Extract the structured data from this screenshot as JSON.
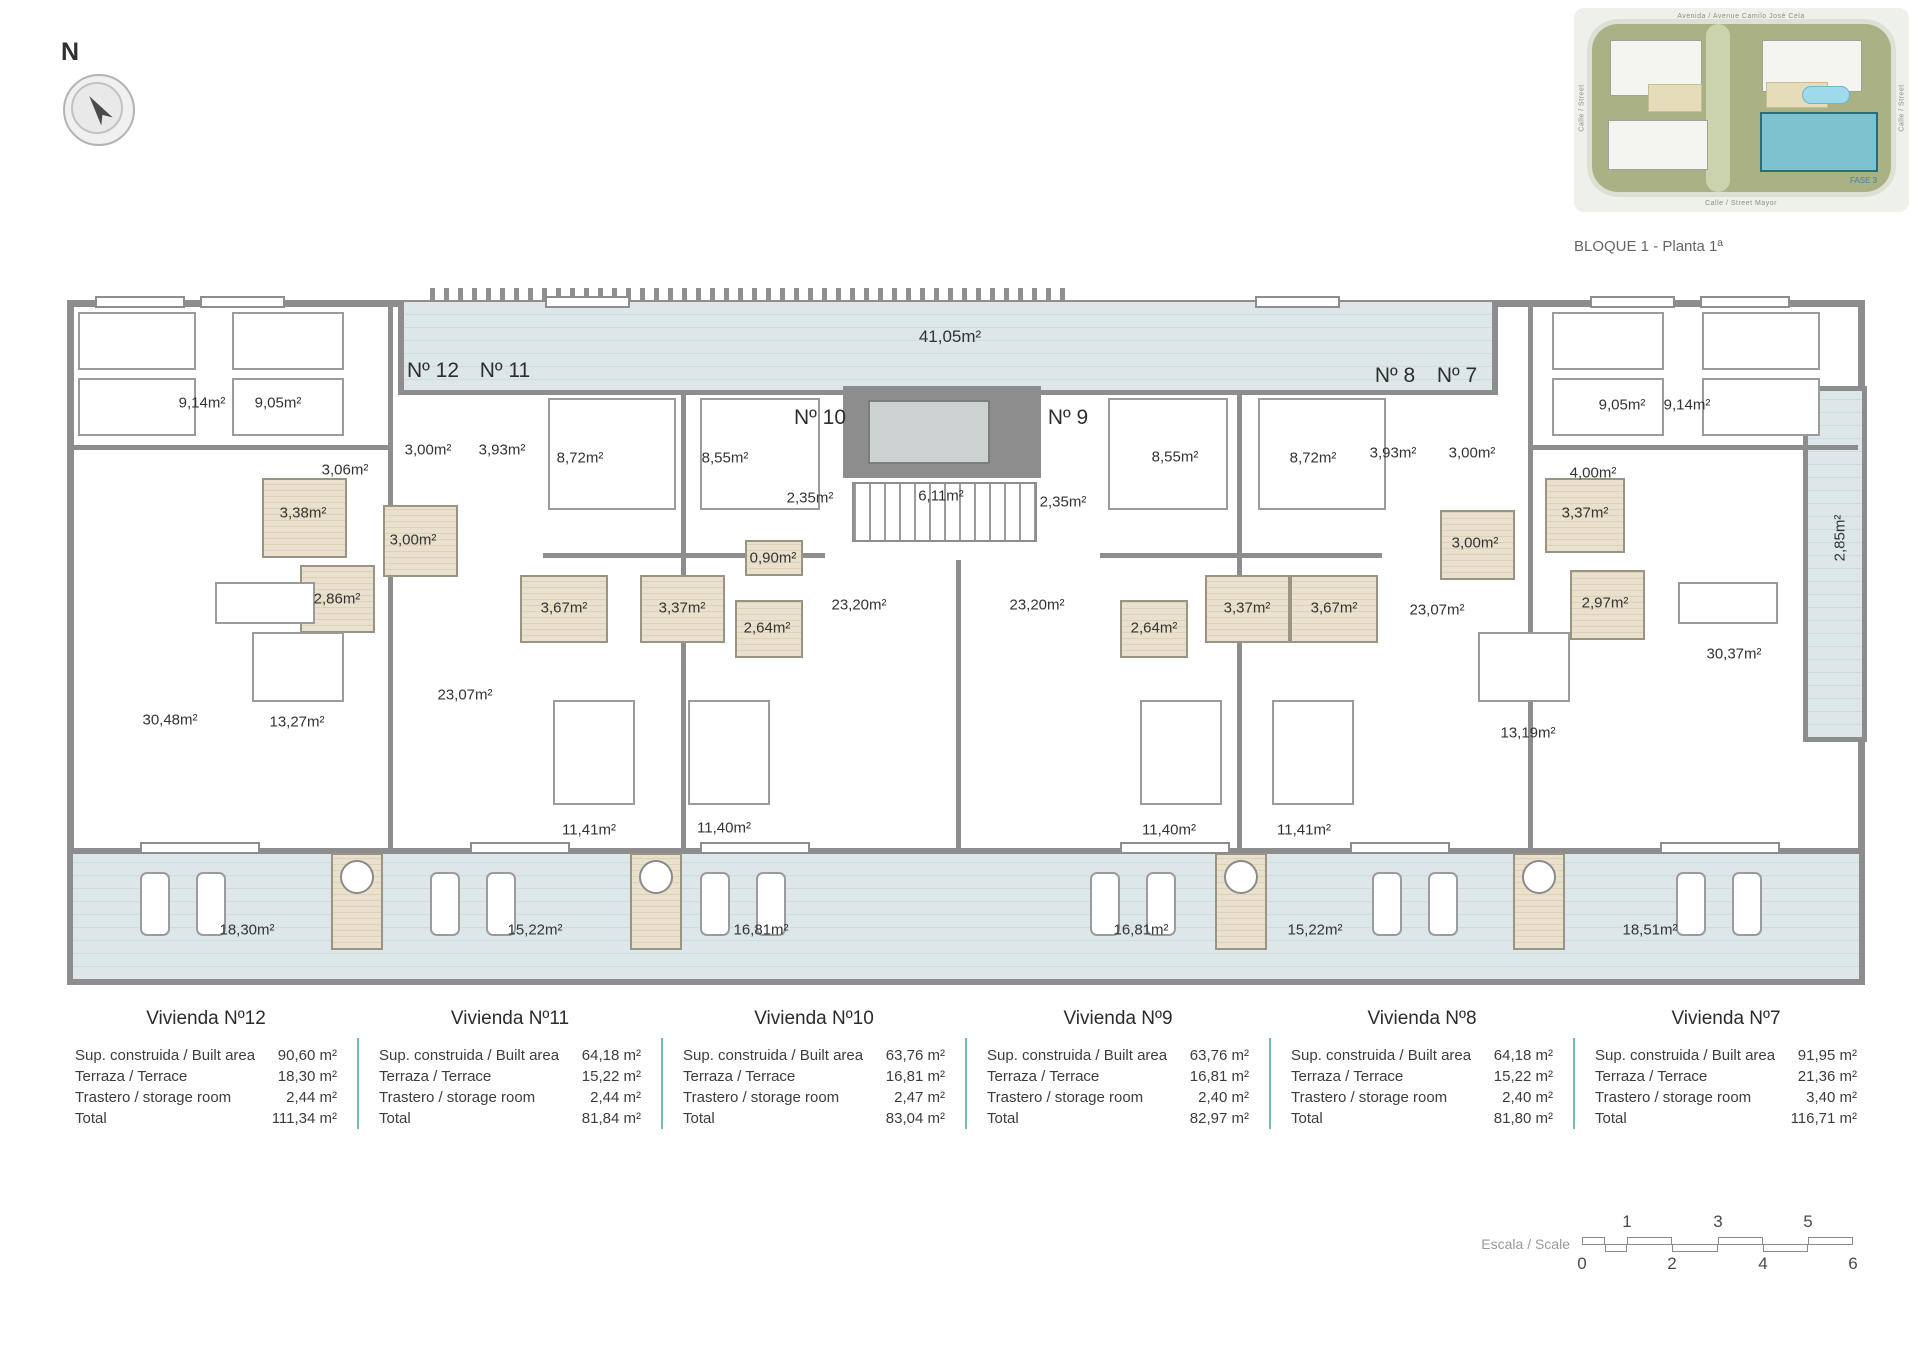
{
  "header": {
    "caption": "BLOQUE 1 - Planta 1ª",
    "north": "N"
  },
  "site_plan": {
    "street_top": "Avenida / Avenue Camilo José Cela",
    "street_bottom": "Calle / Street Mayor",
    "street_left": "Calle / Street",
    "street_right": "Calle / Street",
    "phase": "FASE 3"
  },
  "plan": {
    "labels": [
      {
        "t": "41,05m²",
        "x": 950,
        "y": 337,
        "c": "big"
      },
      {
        "t": "Nº 12",
        "x": 433,
        "y": 371,
        "c": "unit"
      },
      {
        "t": "Nº 11",
        "x": 505,
        "y": 371,
        "c": "unit"
      },
      {
        "t": "Nº 10",
        "x": 820,
        "y": 418,
        "c": "unit"
      },
      {
        "t": "Nº 9",
        "x": 1068,
        "y": 418,
        "c": "unit"
      },
      {
        "t": "Nº 8",
        "x": 1395,
        "y": 376,
        "c": "unit"
      },
      {
        "t": "Nº 7",
        "x": 1457,
        "y": 376,
        "c": "unit"
      },
      {
        "t": "9,14m²",
        "x": 202,
        "y": 403
      },
      {
        "t": "9,05m²",
        "x": 278,
        "y": 403
      },
      {
        "t": "3,06m²",
        "x": 345,
        "y": 470
      },
      {
        "t": "3,00m²",
        "x": 428,
        "y": 450
      },
      {
        "t": "3,93m²",
        "x": 502,
        "y": 450
      },
      {
        "t": "8,72m²",
        "x": 580,
        "y": 458
      },
      {
        "t": "8,55m²",
        "x": 725,
        "y": 458
      },
      {
        "t": "3,38m²",
        "x": 303,
        "y": 513
      },
      {
        "t": "3,00m²",
        "x": 413,
        "y": 540
      },
      {
        "t": "2,86m²",
        "x": 337,
        "y": 599
      },
      {
        "t": "2,35m²",
        "x": 810,
        "y": 498
      },
      {
        "t": "6,11m²",
        "x": 941,
        "y": 496
      },
      {
        "t": "2,35m²",
        "x": 1063,
        "y": 502
      },
      {
        "t": "0,90m²",
        "x": 773,
        "y": 558
      },
      {
        "t": "3,67m²",
        "x": 564,
        "y": 608
      },
      {
        "t": "3,37m²",
        "x": 682,
        "y": 608
      },
      {
        "t": "2,64m²",
        "x": 767,
        "y": 628
      },
      {
        "t": "23,20m²",
        "x": 859,
        "y": 605
      },
      {
        "t": "23,20m²",
        "x": 1037,
        "y": 605
      },
      {
        "t": "2,64m²",
        "x": 1154,
        "y": 628
      },
      {
        "t": "3,37m²",
        "x": 1247,
        "y": 608
      },
      {
        "t": "3,67m²",
        "x": 1334,
        "y": 608
      },
      {
        "t": "8,55m²",
        "x": 1175,
        "y": 457
      },
      {
        "t": "8,72m²",
        "x": 1313,
        "y": 458
      },
      {
        "t": "3,93m²",
        "x": 1393,
        "y": 453
      },
      {
        "t": "3,00m²",
        "x": 1472,
        "y": 453
      },
      {
        "t": "3,00m²",
        "x": 1475,
        "y": 543
      },
      {
        "t": "9,05m²",
        "x": 1622,
        "y": 405
      },
      {
        "t": "9,14m²",
        "x": 1687,
        "y": 405
      },
      {
        "t": "4,00m²",
        "x": 1593,
        "y": 473
      },
      {
        "t": "3,37m²",
        "x": 1585,
        "y": 513
      },
      {
        "t": "2,97m²",
        "x": 1605,
        "y": 603
      },
      {
        "t": "30,48m²",
        "x": 170,
        "y": 720
      },
      {
        "t": "13,27m²",
        "x": 297,
        "y": 722
      },
      {
        "t": "23,07m²",
        "x": 465,
        "y": 695
      },
      {
        "t": "23,07m²",
        "x": 1437,
        "y": 610
      },
      {
        "t": "30,37m²",
        "x": 1734,
        "y": 654
      },
      {
        "t": "13,19m²",
        "x": 1528,
        "y": 733
      },
      {
        "t": "2,85m²",
        "x": 1840,
        "y": 538,
        "c": "rot"
      },
      {
        "t": "11,41m²",
        "x": 589,
        "y": 830
      },
      {
        "t": "11,40m²",
        "x": 724,
        "y": 828
      },
      {
        "t": "11,40m²",
        "x": 1169,
        "y": 830
      },
      {
        "t": "11,41m²",
        "x": 1304,
        "y": 830
      },
      {
        "t": "18,30m²",
        "x": 247,
        "y": 930
      },
      {
        "t": "15,22m²",
        "x": 535,
        "y": 930
      },
      {
        "t": "16,81m²",
        "x": 761,
        "y": 930
      },
      {
        "t": "16,81m²",
        "x": 1141,
        "y": 930
      },
      {
        "t": "15,22m²",
        "x": 1315,
        "y": 930
      },
      {
        "t": "18,51m²",
        "x": 1650,
        "y": 930
      }
    ]
  },
  "tables": {
    "row_labels": [
      "Sup. construida / Built area",
      "Terraza / Terrace",
      "Trastero / storage room",
      "Total"
    ],
    "units": [
      {
        "title": "Vivienda Nº12",
        "values": [
          "90,60 m²",
          "18,30 m²",
          "2,44 m²",
          "111,34 m²"
        ]
      },
      {
        "title": "Vivienda Nº11",
        "values": [
          "64,18 m²",
          "15,22 m²",
          "2,44 m²",
          "81,84 m²"
        ]
      },
      {
        "title": "Vivienda Nº10",
        "values": [
          "63,76 m²",
          "16,81 m²",
          "2,47 m²",
          "83,04 m²"
        ]
      },
      {
        "title": "Vivienda Nº9",
        "values": [
          "63,76 m²",
          "16,81 m²",
          "2,40 m²",
          "82,97 m²"
        ]
      },
      {
        "title": "Vivienda Nº8",
        "values": [
          "64,18 m²",
          "15,22 m²",
          "2,40 m²",
          "81,80 m²"
        ]
      },
      {
        "title": "Vivienda Nº7",
        "values": [
          "91,95 m²",
          "21,36 m²",
          "3,40 m²",
          "116,71 m²"
        ]
      }
    ]
  },
  "scale": {
    "label": "Escala / Scale",
    "top": [
      "1",
      "3",
      "5"
    ],
    "bottom": [
      "0",
      "2",
      "4",
      "6"
    ]
  }
}
